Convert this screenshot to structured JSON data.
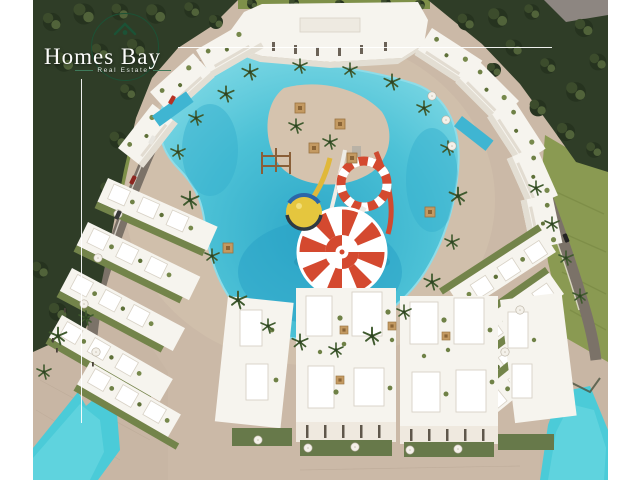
{
  "logo": {
    "brand": "Homes Bay",
    "tagline": "Real Estate",
    "icon": "house-in-circle-icon",
    "colors": {
      "text": "#fdfdfb",
      "circle_green": "#1c5236",
      "crosshair_line": "#ffffff"
    }
  },
  "scene": {
    "name": "Homes Bay resort aerial 3D render",
    "features": [
      "pine forest border",
      "perimeter roads with cars",
      "white apartment ring around swim lagoon",
      "turquoise lagoon pool",
      "red-white funnel water slide",
      "striped ring slide",
      "yellow climbing ball",
      "rooftop-garden townhouses",
      "garden umbrellas",
      "beach water in bottom corners",
      "palm trees",
      "central sand island with cabanas"
    ],
    "colors": {
      "sand": "#cbb9a7",
      "plaza": "#c8b6a4",
      "forest": "#2f3d27",
      "lawn": "#8a9a52",
      "road": "#7b7268",
      "lagoon": "#4cc1d6",
      "lagoon_deep": "#2aa3c6",
      "sea": "#4bcbd8",
      "building": "#f6f4ee",
      "building_shade": "#e3ded3",
      "roof_garden": "#6f8146",
      "slide_red": "#d4492f",
      "slide_white": "#ffffff",
      "ball_yellow": "#e5c63e",
      "pergola": "#c49a62",
      "umbrella": "#f2efe8"
    }
  }
}
